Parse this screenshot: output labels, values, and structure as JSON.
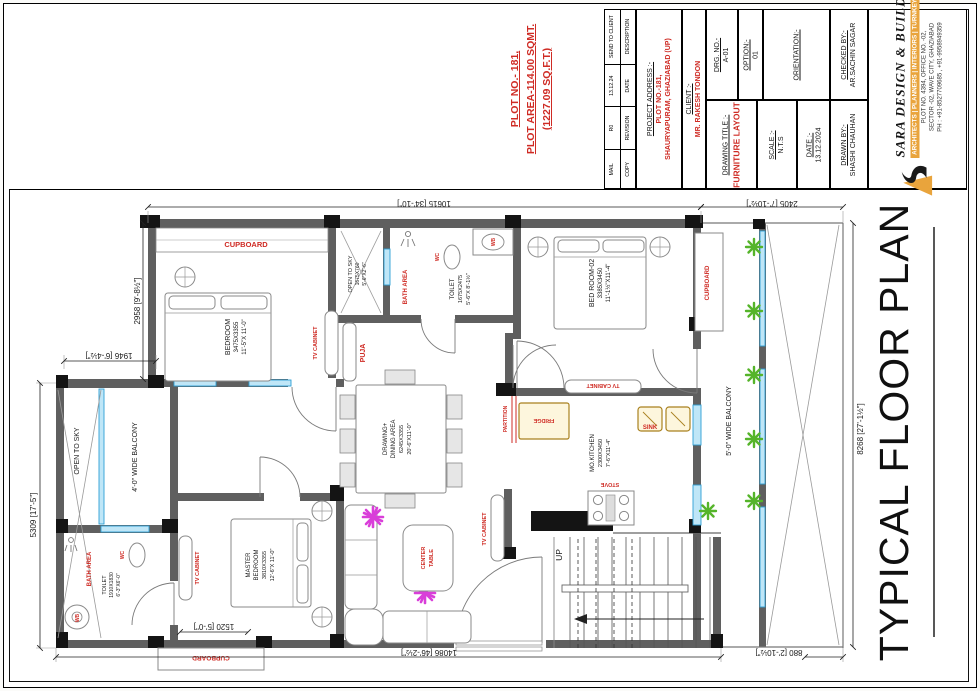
{
  "plot_note": {
    "l1": "PLOT NO.- 181,",
    "l2": "PLOT AREA-114.00 SQMT.",
    "l3": "(1227.09 SQ.F.T.)"
  },
  "revision": {
    "entries": [
      {
        "value": "MAIL",
        "label": "COPY"
      },
      {
        "value": "R0",
        "label": "REVISION"
      },
      {
        "value": "13.12.24",
        "label": "DATE"
      },
      {
        "value": "SEND TO CLIENT",
        "label": "DESCRIPTION"
      }
    ]
  },
  "title_block": {
    "project_address_label": "PROJECT ADDRESS :-",
    "project_address_l1": "PLOT NO.-181,",
    "project_address_l2": "SHAURYAPURAM, GHAZIABAD (UP)",
    "client_label": "CLIENT :-",
    "client": "MR. RAKESH TONDON",
    "drg_no_label": "DRG. NO.-",
    "drg_no": "A-01",
    "option_label": "OPTION:-",
    "option": "01",
    "orientation_label": "ORIENTATION:-",
    "drawing_title_label": "DRAWING TITLE :-",
    "drawing_title": "FURNITURE LAYOUT",
    "scale_label": "SCALE :-",
    "scale": "N.T.S",
    "date_label": "DATE :-",
    "date": "13.12.2024",
    "drawn_by_label": "DRAWN BY:-",
    "drawn_by": "SHASHI CHAUHAN",
    "checked_by_label": "CHECKED BY:-",
    "checked_by": "AR.SACHIN SAGAR"
  },
  "company": {
    "name": "SARA DESIGN & BUILD",
    "tagline": "ARCHITECTS | PLANNERS | INTERIORS | TURNKEY",
    "address1": "PLOT NO. 4394, OFFICE NO. -02,",
    "address2": "SECTOR -02, WAVE CITY, GHAZIABAD",
    "phone": "PH : +91-8527709685 , +91-9958949359"
  },
  "plan": {
    "title": "TYPICAL FLOOR PLAN",
    "dims": {
      "top": "10615 [34'-10\"]",
      "top_right": "2405 [7'-10½\"]",
      "right": "8268 [27'-1½\"]",
      "bottom": "14086 [46'-2½\"]",
      "bottom_right": "880 [2'-10½\"]",
      "left": "5309 [17'-5\"]",
      "left_upper": "1946 [6'-4½\"]",
      "left_mid": "2958 [9'-8½\"]",
      "cupboard": "1520 [5'-0\"]"
    },
    "rooms": {
      "bedroom1": {
        "l1": "BEDROOM",
        "l2": "3475X3355",
        "l3": "11'-5\"X 11'-0\""
      },
      "bedroom2": {
        "l1": "BED ROOM-02",
        "l2": "3385X3450",
        "l3": "11'-1½\"X11'-4\""
      },
      "toilet_top": {
        "l1": "TOILET",
        "l2": "1675X2475",
        "l3": "5'-6\"X 8'-1½\""
      },
      "open_sky_top": {
        "l1": "OPEN TO SKY",
        "l2": "1675X760",
        "l3": "5'-6\"X2'-6\""
      },
      "drawing_dining": {
        "l1": "DRAWING+",
        "l2": "DINING AREA",
        "l3": "6245X3355",
        "l4": "20'-6\"X11'-0\""
      },
      "kitchen": {
        "l1": "MO.KITCHEN",
        "l2": "2300X3450",
        "l3": "7'-6\"X11'-4\""
      },
      "master": {
        "l1": "MASTER",
        "l2": "BEDROOM",
        "l3": "3810X3355",
        "l4": "12'-6\"X 11'-0\""
      },
      "toilet_bottom": {
        "l1": "TOILET",
        "l2": "1910X1830",
        "l3": "6'-3\"X6'-0\""
      },
      "balcony_left": "4'-0\" WIDE BALCONY",
      "balcony_right": "5'-0\" WIDE BALCONY"
    },
    "labels": {
      "cupboard": "CUPBOARD",
      "tv_cabinet": "TV CABINET",
      "puja": "PUJA",
      "bath_area": "BATH AREA",
      "wc": "WC",
      "wb": "WB",
      "fridge": "FRIDGE",
      "sink": "SINK",
      "stove": "STOVE",
      "partition": "PARTITION",
      "up": "UP",
      "center_l1": "CENTER",
      "center_l2": "TABLE",
      "open_to_sky": "OPEN TO SKY"
    },
    "colors": {
      "label_red": "#cf2b24",
      "glazing_blue": "#45aadd",
      "plant_green": "#55b42a",
      "decor_magenta": "#d93ed9",
      "counter_gold": "#a9811f",
      "wall_grey": "#5f5f5f"
    }
  }
}
